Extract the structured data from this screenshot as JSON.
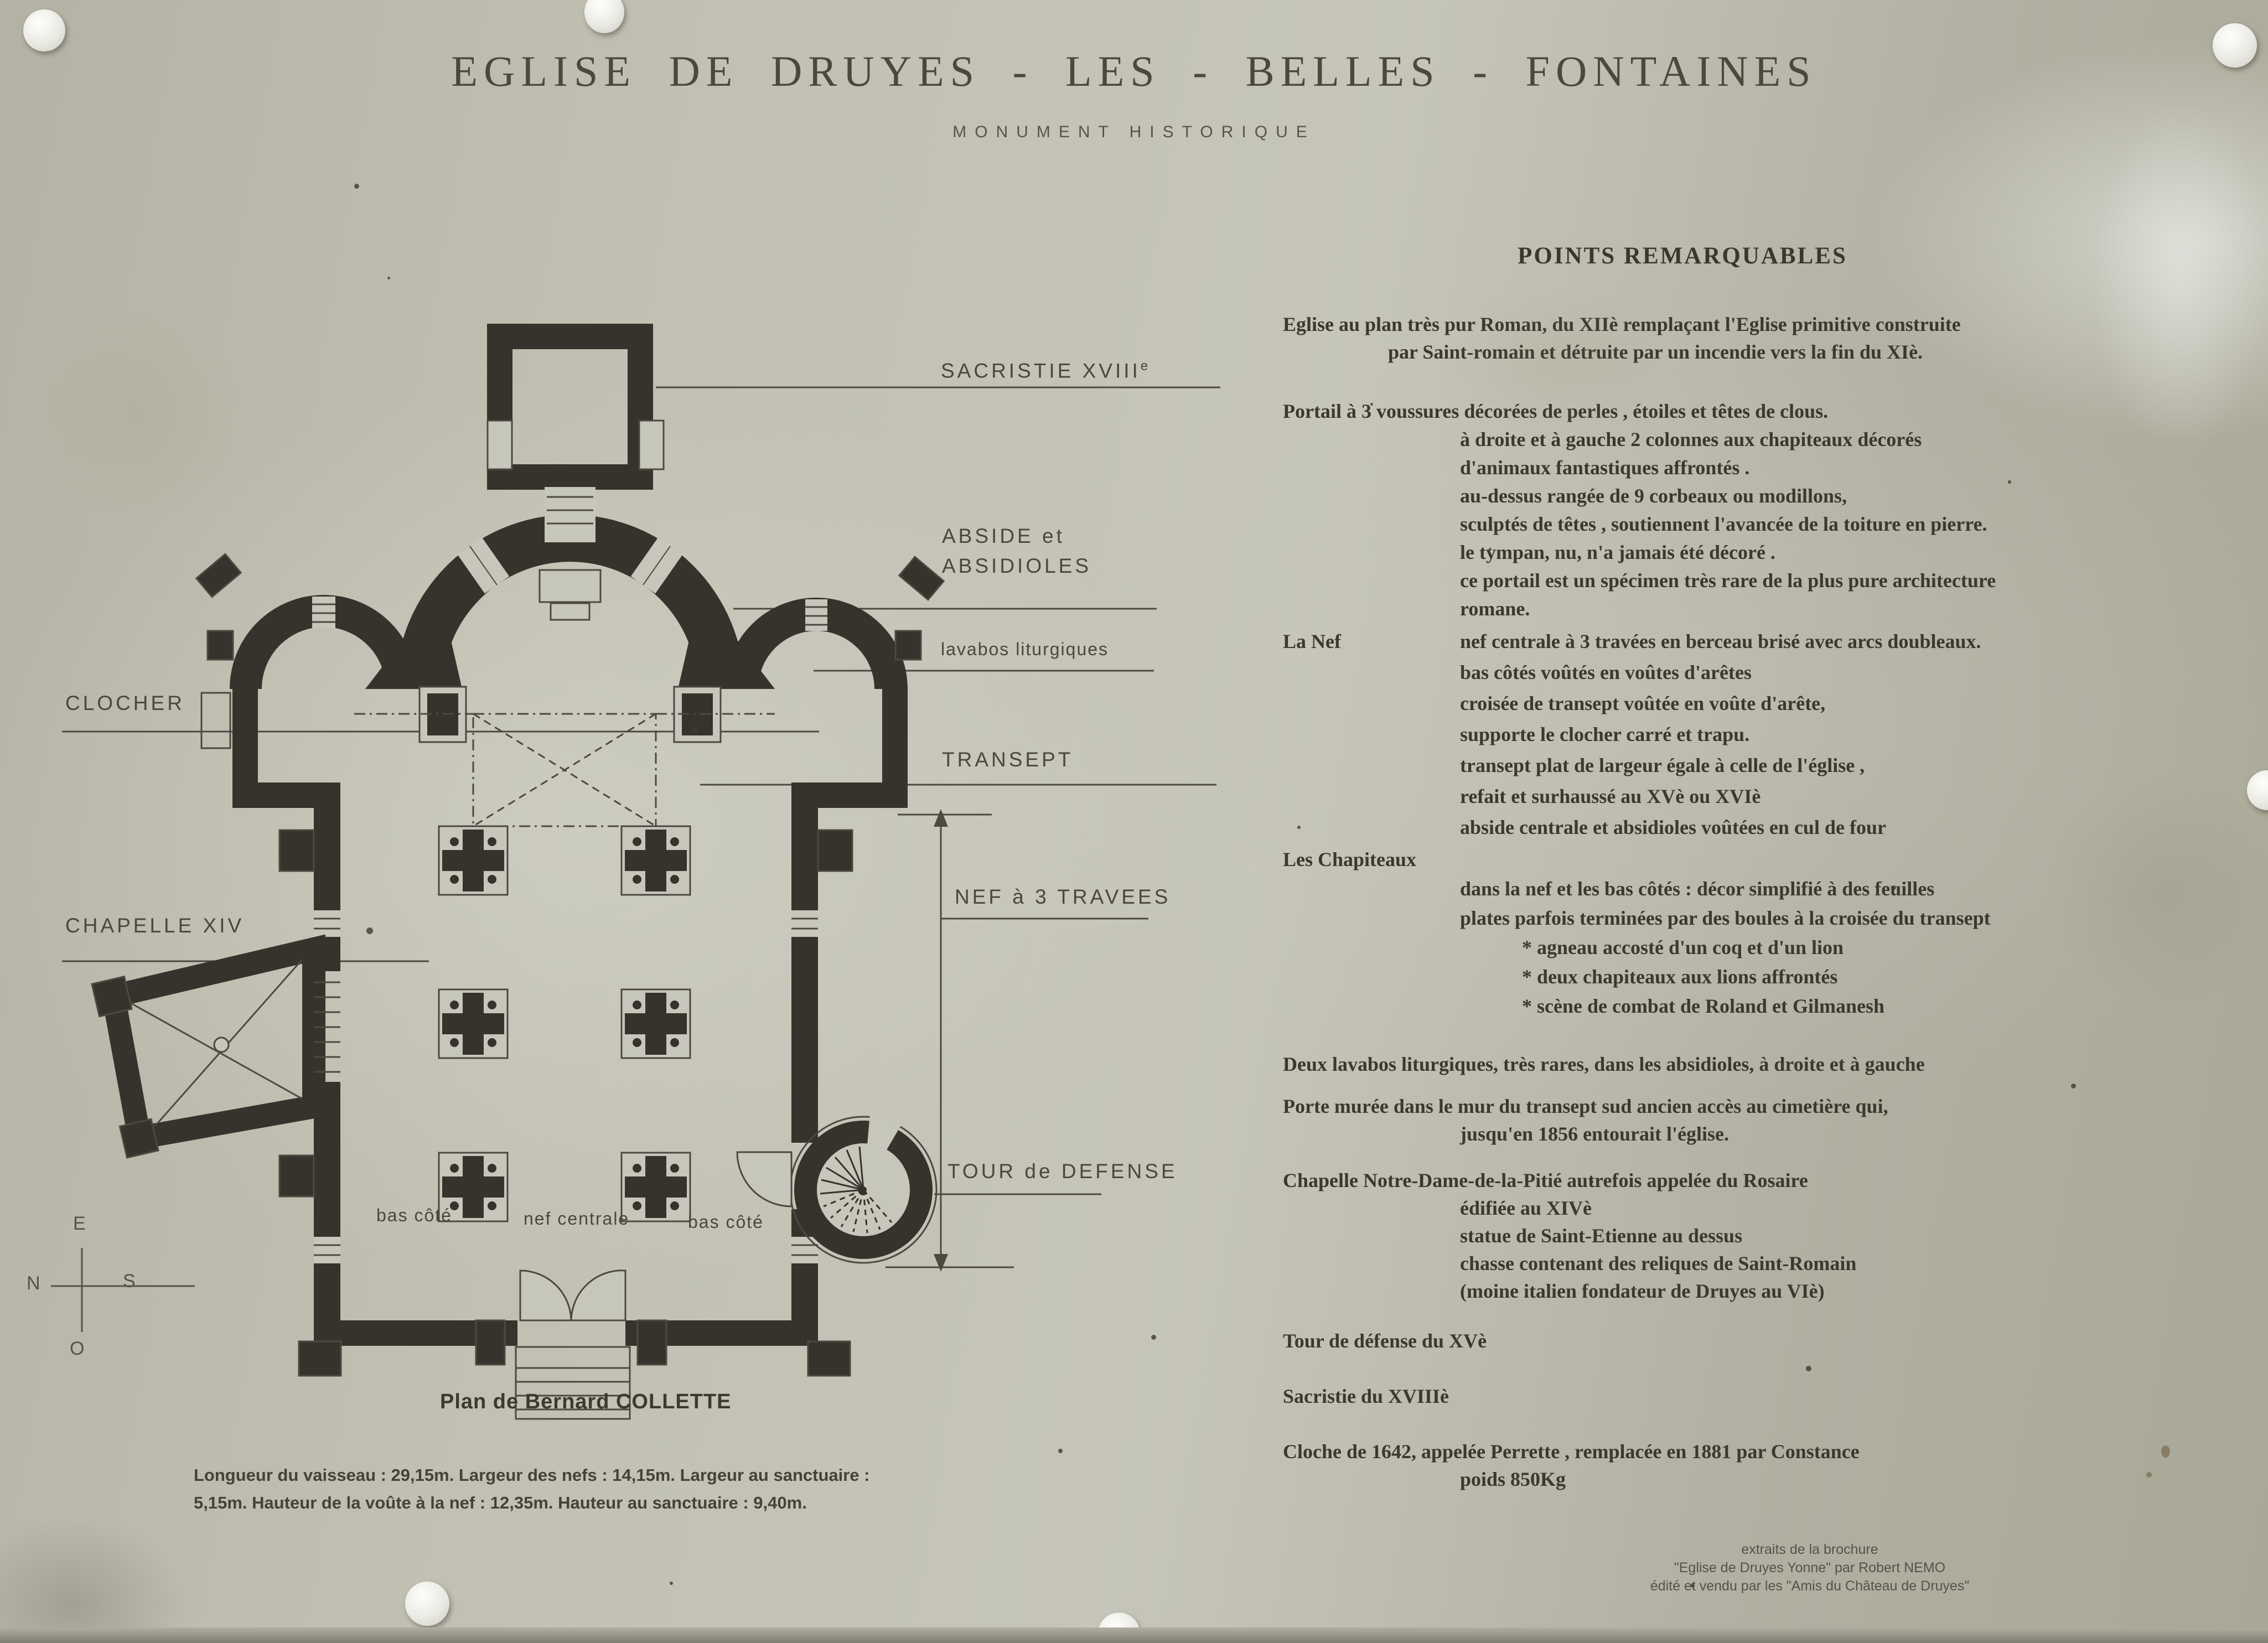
{
  "panel": {
    "title": "EGLISE DE DRUYES - LES - BELLES - FONTAINES",
    "subtitle": "MONUMENT HISTORIQUE"
  },
  "plan": {
    "labels": {
      "sacristie_main": "SACRISTIE XVIII",
      "sacristie_sup": "e",
      "abside_line1": "ABSIDE et",
      "abside_line2": "ABSIDIOLES",
      "lavabos": "lavabos liturgiques",
      "transept": "TRANSEPT",
      "clocher": "CLOCHER",
      "chapelle": "CHAPELLE XIV",
      "nef": "NEF à 3 TRAVEES",
      "tour": "TOUR de DEFENSE",
      "bas_cote_left": "bas côté",
      "nef_centrale": "nef centrale",
      "bas_cote_right": "bas côté"
    },
    "compass": {
      "top": "E",
      "left": "N",
      "right": "S",
      "bottom": "O"
    },
    "caption": "Plan de Bernard COLLETTE",
    "dimensions_line1": "Longueur du vaisseau : 29,15m. Largeur des nefs : 14,15m. Largeur au sanctuaire :",
    "dimensions_line2": "5,15m. Hauteur de la voûte à la nef : 12,35m. Hauteur au sanctuaire : 9,40m."
  },
  "points": {
    "heading": "POINTS REMARQUABLES",
    "sections": [
      {
        "lines": [
          {
            "t": "Eglise au plan très pur Roman, du XIIè remplaçant l'Eglise primitive construite",
            "i": 0
          },
          {
            "t": "par Saint-romain et détruite par un incendie vers la fin du XIè.",
            "i": 1
          }
        ]
      },
      {
        "lines": [
          {
            "t": "Portail à 3 voussures décorées de perles , étoiles et têtes de clous.",
            "i": 0
          },
          {
            "t": "à droite et à gauche 2 colonnes aux chapiteaux décorés",
            "i": 2
          },
          {
            "t": "d'animaux fantastiques affrontés .",
            "i": 2
          },
          {
            "t": "au-dessus rangée de 9 corbeaux ou modillons,",
            "i": 2
          },
          {
            "t": "sculptés de têtes , soutiennent l'avancée de la toiture en pierre.",
            "i": 2
          },
          {
            "t": "le tympan, nu, n'a jamais été décoré .",
            "i": 2
          },
          {
            "t": "ce portail est un spécimen très rare de la plus pure architecture",
            "i": 2
          },
          {
            "t": "romane.",
            "i": 2
          }
        ]
      },
      {
        "label": "La Nef",
        "label_inline": true,
        "lines": [
          {
            "t": "nef centrale à 3 travées en berceau brisé avec arcs doubleaux.",
            "i": 2
          },
          {
            "t": "bas côtés voûtés en voûtes d'arêtes",
            "i": 2
          },
          {
            "t": "croisée de transept voûtée en voûte d'arête,",
            "i": 2
          },
          {
            "t": "supporte le clocher carré et trapu.",
            "i": 2
          },
          {
            "t": "transept plat de largeur égale à celle de l'église ,",
            "i": 2
          },
          {
            "t": "refait et surhaussé au XVè ou XVIè",
            "i": 2
          },
          {
            "t": "abside centrale et absidioles voûtées en cul de four",
            "i": 2
          }
        ]
      },
      {
        "label": "Les Chapiteaux",
        "label_inline": false,
        "lines": [
          {
            "t": "dans la nef et les bas côtés : décor simplifié à des feuilles",
            "i": 2
          },
          {
            "t": "plates parfois terminées par des boules à la croisée du transept",
            "i": 2
          },
          {
            "t": "* agneau accosté d'un coq et d'un lion",
            "i": 3
          },
          {
            "t": "* deux chapiteaux aux lions affrontés",
            "i": 3
          },
          {
            "t": "* scène de combat de Roland et Gilmanesh",
            "i": 3
          }
        ]
      },
      {
        "lines": [
          {
            "t": "Deux lavabos liturgiques, très rares, dans les absidioles, à droite et à gauche",
            "i": 0
          }
        ]
      },
      {
        "lines": [
          {
            "t": "Porte murée dans le mur du transept sud ancien accès au cimetière qui,",
            "i": 0
          },
          {
            "t": "jusqu'en 1856 entourait l'église.",
            "i": 2
          }
        ]
      },
      {
        "lines": [
          {
            "t": "Chapelle Notre-Dame-de-la-Pitié autrefois appelée du Rosaire",
            "i": 0
          },
          {
            "t": "édifiée au XIVè",
            "i": 2
          },
          {
            "t": "statue de Saint-Etienne au dessus",
            "i": 2
          },
          {
            "t": "chasse contenant des reliques de Saint-Romain",
            "i": 2
          },
          {
            "t": "(moine italien fondateur de Druyes au VIè)",
            "i": 2
          }
        ]
      },
      {
        "lines": [
          {
            "t": "Tour de défense du XVè",
            "i": 0
          }
        ]
      },
      {
        "lines": [
          {
            "t": "Sacristie du XVIIIè",
            "i": 0
          }
        ]
      },
      {
        "lines": [
          {
            "t": "Cloche de 1642, appelée Perrette , remplacée en 1881 par Constance",
            "i": 0
          },
          {
            "t": "poids 850Kg",
            "i": 2
          }
        ]
      }
    ]
  },
  "footer": {
    "line1": "extraits de la brochure",
    "line2": "\"Eglise de Druyes Yonne\" par Robert NEMO",
    "line3": "édité et vendu par les \"Amis du Château de Druyes\""
  }
}
